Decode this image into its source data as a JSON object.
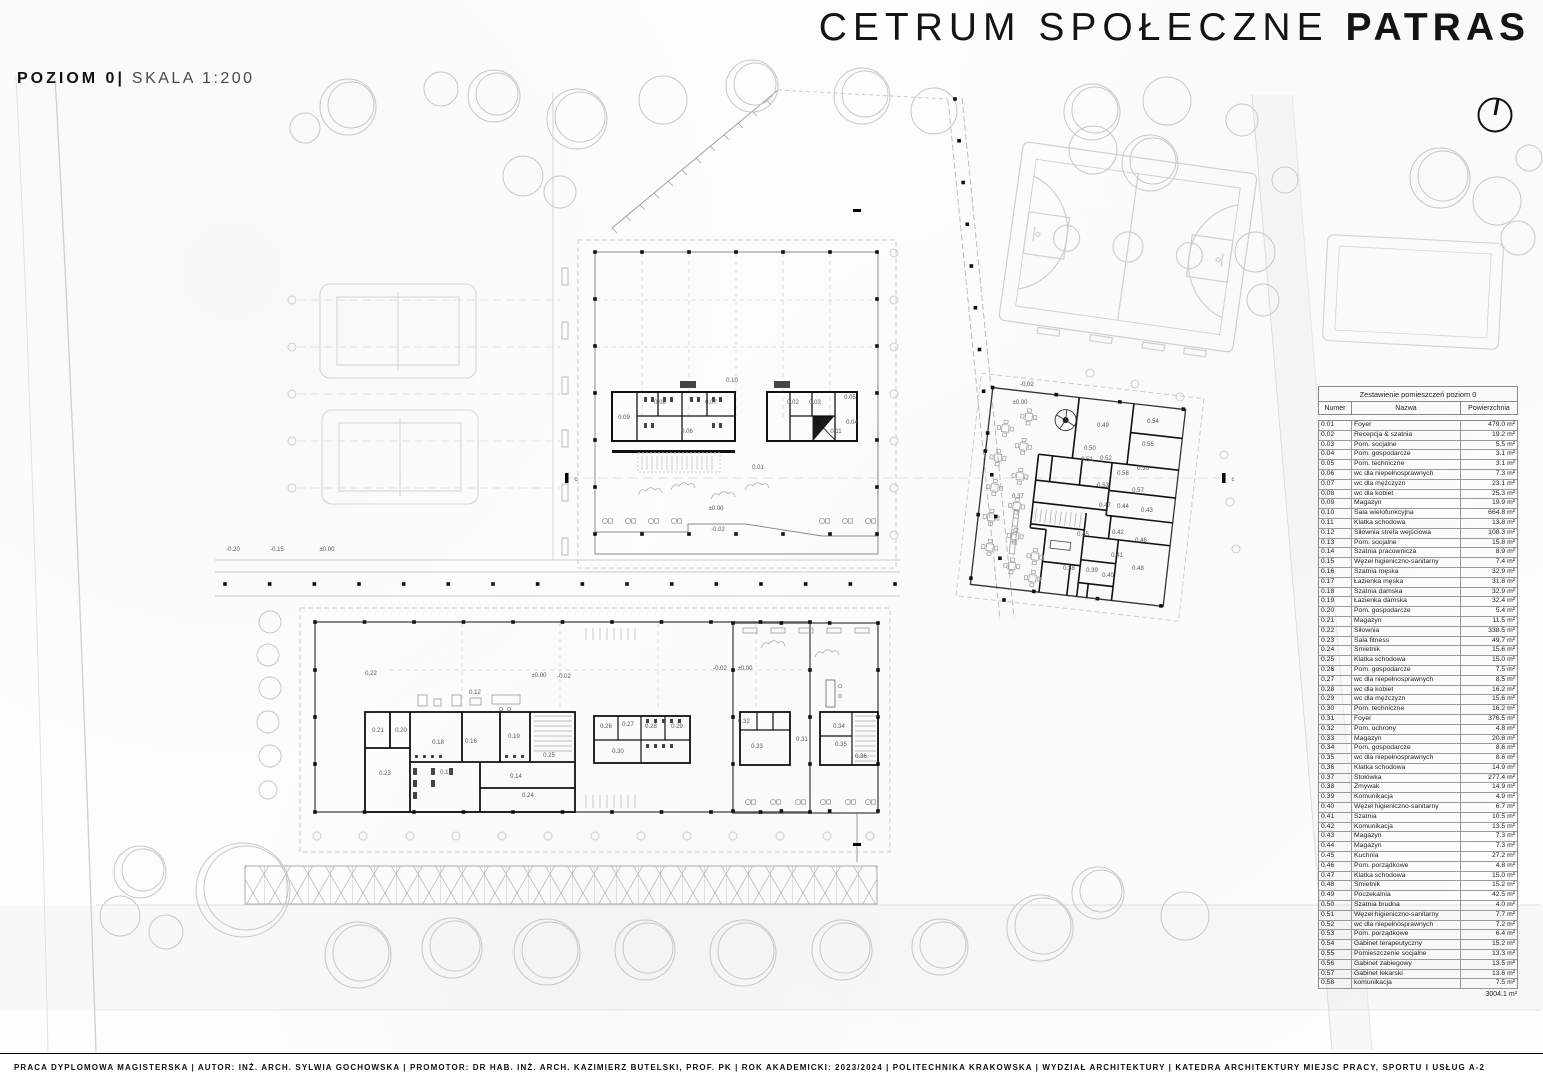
{
  "title": {
    "regular": "CETRUM SPOŁECZNE",
    "bold": "PATRAS"
  },
  "subtitle": {
    "level": "POZIOM 0",
    "separator": "|",
    "scale": "SKALA 1:200"
  },
  "icons": {
    "north_arrow": "north-arrow-icon"
  },
  "table": {
    "title": "Zestawienie pomieszczeń poziom 0",
    "columns": [
      "Numer",
      "Nazwa",
      "Powierzchnia"
    ],
    "rows": [
      [
        "0.01",
        "Foyer",
        "479.0 m²"
      ],
      [
        "0.02",
        "Recepcja & szatnia",
        "19.2 m²"
      ],
      [
        "0.03",
        "Pom. socjalne",
        "5.5 m²"
      ],
      [
        "0.04",
        "Pom. gospodarcze",
        "3.1 m²"
      ],
      [
        "0.05",
        "Pom. techniczne",
        "3.1 m²"
      ],
      [
        "0.06",
        "wc dla niepełnosprawnych",
        "7.3 m²"
      ],
      [
        "0.07",
        "wc dla mężczyzn",
        "23.1 m²"
      ],
      [
        "0.08",
        "wc dla kobiet",
        "25.3 m²"
      ],
      [
        "0.09",
        "Magazyn",
        "19.9 m²"
      ],
      [
        "0.10",
        "Sala wielofunkcyjna",
        "664.8 m²"
      ],
      [
        "0.11",
        "Klatka schodowa",
        "13.8 m²"
      ],
      [
        "0.12",
        "Siłownia strefa wejściowa",
        "108.3 m²"
      ],
      [
        "0.13",
        "Pom. socjalne",
        "15.8 m²"
      ],
      [
        "0.14",
        "Szatnia pracownicza",
        "8.9 m²"
      ],
      [
        "0.15",
        "Węzeł higieniczno-sanitarny",
        "7.4 m²"
      ],
      [
        "0.16",
        "Szatnia męska",
        "32.9 m²"
      ],
      [
        "0.17",
        "Łazienka męska",
        "31.8 m²"
      ],
      [
        "0.18",
        "Szatnia damska",
        "32.9 m²"
      ],
      [
        "0.19",
        "Łazienka damska",
        "32.4 m²"
      ],
      [
        "0.20",
        "Pom. gospodarcze",
        "5.4 m²"
      ],
      [
        "0.21",
        "Magazyn",
        "11.5 m²"
      ],
      [
        "0.22",
        "Siłownia",
        "338.5 m²"
      ],
      [
        "0.23",
        "Sala fitness",
        "49.7 m²"
      ],
      [
        "0.24",
        "Śmietnik",
        "15.6 m²"
      ],
      [
        "0.25",
        "Klatka schodowa",
        "15.0 m²"
      ],
      [
        "0.26",
        "Pom. gospodarcze",
        "7.5 m²"
      ],
      [
        "0.27",
        "wc dla niepełnosprawnych",
        "8.5 m²"
      ],
      [
        "0.28",
        "wc dla kobiet",
        "16.2 m²"
      ],
      [
        "0.29",
        "wc dla mężczyzn",
        "15.6 m²"
      ],
      [
        "0.30",
        "Pom. techniczne",
        "16.2 m²"
      ],
      [
        "0.31",
        "Foyer",
        "376.5 m²"
      ],
      [
        "0.32",
        "Pom. ochrony",
        "4.8 m²"
      ],
      [
        "0.33",
        "Magazyn",
        "20.8 m²"
      ],
      [
        "0.34",
        "Pom. gospodarcze",
        "8.6 m²"
      ],
      [
        "0.35",
        "wc dla niepełnosprawnych",
        "8.6 m²"
      ],
      [
        "0.36",
        "Klatka schodowa",
        "14.9 m²"
      ],
      [
        "0.37",
        "Stołówka",
        "277.4 m²"
      ],
      [
        "0.38",
        "Zmywak",
        "14.9 m²"
      ],
      [
        "0.39",
        "Komunikacja",
        "4.9 m²"
      ],
      [
        "0.40",
        "Węzeł higieniczno-sanitarny",
        "6.7 m²"
      ],
      [
        "0.41",
        "Szatnia",
        "10.5 m²"
      ],
      [
        "0.42",
        "Komunikacja",
        "13.5 m²"
      ],
      [
        "0.43",
        "Magazyn",
        "7.3 m²"
      ],
      [
        "0.44",
        "Magazyn",
        "7.3 m²"
      ],
      [
        "0.45",
        "Kuchnia",
        "27.2 m²"
      ],
      [
        "0.46",
        "Pom. porządkowe",
        "4.8 m²"
      ],
      [
        "0.47",
        "Klatka schodowa",
        "15.0 m²"
      ],
      [
        "0.48",
        "Śmietnik",
        "15.2 m²"
      ],
      [
        "0.49",
        "Poczekalnia",
        "42.5 m²"
      ],
      [
        "0.50",
        "Szatnia brudna",
        "4.0 m²"
      ],
      [
        "0.51",
        "Węzeł higieniczno-sanitarny",
        "7.7 m²"
      ],
      [
        "0.52",
        "wc dla niepełnosprawnych",
        "7.2 m²"
      ],
      [
        "0.53",
        "Pom. porządkowe",
        "6.4 m²"
      ],
      [
        "0.54",
        "Gabinet terapeutyczny",
        "15.2 m²"
      ],
      [
        "0.55",
        "Pomieszczenie socjalne",
        "13.3 m²"
      ],
      [
        "0.56",
        "Gabinet zabiegowy",
        "13.5 m²"
      ],
      [
        "0.57",
        "Gabinet lekarski",
        "13.6 m²"
      ],
      [
        "0.58",
        "komunikacja",
        "7.5 m²"
      ]
    ],
    "total": "3004.1 m²"
  },
  "plan": {
    "labels": [
      {
        "t": "0.10",
        "x": 732,
        "y": 382
      },
      {
        "t": "0.09",
        "x": 624,
        "y": 419
      },
      {
        "t": "0.08",
        "x": 660,
        "y": 404
      },
      {
        "t": "0.07",
        "x": 711,
        "y": 404
      },
      {
        "t": "0.06",
        "x": 687,
        "y": 433
      },
      {
        "t": "0.02",
        "x": 793,
        "y": 404
      },
      {
        "t": "0.03",
        "x": 815,
        "y": 404
      },
      {
        "t": "0.05",
        "x": 850,
        "y": 399
      },
      {
        "t": "0.04",
        "x": 852,
        "y": 424
      },
      {
        "t": "0.11",
        "x": 836,
        "y": 433
      },
      {
        "t": "0.01",
        "x": 758,
        "y": 469
      },
      {
        "t": "±0.00",
        "x": 716,
        "y": 510
      },
      {
        "t": "-0.02",
        "x": 718,
        "y": 531
      },
      {
        "t": "-0.20",
        "x": 233,
        "y": 551
      },
      {
        "t": "-0.15",
        "x": 277,
        "y": 551
      },
      {
        "t": "±0.00",
        "x": 327,
        "y": 551
      },
      {
        "t": "0.22",
        "x": 371,
        "y": 675
      },
      {
        "t": "0.12",
        "x": 475,
        "y": 694
      },
      {
        "t": "±0.00",
        "x": 539,
        "y": 677
      },
      {
        "t": "-0.02",
        "x": 564,
        "y": 678
      },
      {
        "t": "0.21",
        "x": 378,
        "y": 732
      },
      {
        "t": "0.20",
        "x": 401,
        "y": 732
      },
      {
        "t": "0.18",
        "x": 438,
        "y": 744
      },
      {
        "t": "0.16",
        "x": 471,
        "y": 743
      },
      {
        "t": "0.19",
        "x": 514,
        "y": 738
      },
      {
        "t": "0.25",
        "x": 549,
        "y": 757
      },
      {
        "t": "0.23",
        "x": 385,
        "y": 775
      },
      {
        "t": "0.17",
        "x": 446,
        "y": 774
      },
      {
        "t": "0.14",
        "x": 516,
        "y": 778
      },
      {
        "t": "0.24",
        "x": 528,
        "y": 797
      },
      {
        "t": "0.26",
        "x": 606,
        "y": 728
      },
      {
        "t": "0.27",
        "x": 628,
        "y": 726
      },
      {
        "t": "0.28",
        "x": 651,
        "y": 728
      },
      {
        "t": "0.29",
        "x": 677,
        "y": 728
      },
      {
        "t": "0.30",
        "x": 618,
        "y": 753
      },
      {
        "t": "-0.02",
        "x": 720,
        "y": 670
      },
      {
        "t": "±0.00",
        "x": 745,
        "y": 670
      },
      {
        "t": "0.32",
        "x": 744,
        "y": 723
      },
      {
        "t": "0.33",
        "x": 757,
        "y": 748
      },
      {
        "t": "0.31",
        "x": 802,
        "y": 741
      },
      {
        "t": "0.34",
        "x": 839,
        "y": 728
      },
      {
        "t": "0.35",
        "x": 841,
        "y": 746
      },
      {
        "t": "0.36",
        "x": 861,
        "y": 758
      },
      {
        "t": "-0.02",
        "x": 1027,
        "y": 386
      },
      {
        "t": "±0.00",
        "x": 1020,
        "y": 404
      },
      {
        "t": "0.37",
        "x": 1018,
        "y": 498
      },
      {
        "t": "0.49",
        "x": 1103,
        "y": 427
      },
      {
        "t": "0.54",
        "x": 1153,
        "y": 423
      },
      {
        "t": "0.55",
        "x": 1148,
        "y": 446
      },
      {
        "t": "0.50",
        "x": 1090,
        "y": 450
      },
      {
        "t": "0.51",
        "x": 1087,
        "y": 461
      },
      {
        "t": "0.52",
        "x": 1106,
        "y": 460
      },
      {
        "t": "0.56",
        "x": 1143,
        "y": 470
      },
      {
        "t": "0.58",
        "x": 1123,
        "y": 475
      },
      {
        "t": "0.53",
        "x": 1103,
        "y": 487
      },
      {
        "t": "0.57",
        "x": 1138,
        "y": 492
      },
      {
        "t": "0.47",
        "x": 1105,
        "y": 507
      },
      {
        "t": "0.44",
        "x": 1123,
        "y": 508
      },
      {
        "t": "0.43",
        "x": 1147,
        "y": 512
      },
      {
        "t": "0.45",
        "x": 1083,
        "y": 536
      },
      {
        "t": "0.42",
        "x": 1118,
        "y": 534
      },
      {
        "t": "0.46",
        "x": 1141,
        "y": 542
      },
      {
        "t": "0.41",
        "x": 1117,
        "y": 557
      },
      {
        "t": "0.38",
        "x": 1069,
        "y": 570
      },
      {
        "t": "0.39",
        "x": 1092,
        "y": 572
      },
      {
        "t": "0.40",
        "x": 1108,
        "y": 577
      },
      {
        "t": "0.48",
        "x": 1138,
        "y": 570
      },
      {
        "t": "c",
        "x": 576,
        "y": 481
      },
      {
        "t": "c",
        "x": 1233,
        "y": 481
      }
    ]
  },
  "footer": {
    "text": "PRACA DYPLOMOWA MAGISTERSKA | AUTOR: INŻ. ARCH. SYLWIA GOCHOWSKA | PROMOTOR: DR HAB. INŻ. ARCH. KAZIMIERZ BUTELSKI, PROF. PK | ROK AKADEMICKI: 2023/2024 | POLITECHNIKA KRAKOWSKA | WYDZIAŁ ARCHITEKTURY | KATEDRA ARCHITEKTURY MIEJSC PRACY, SPORTU I USŁUG A-2"
  }
}
